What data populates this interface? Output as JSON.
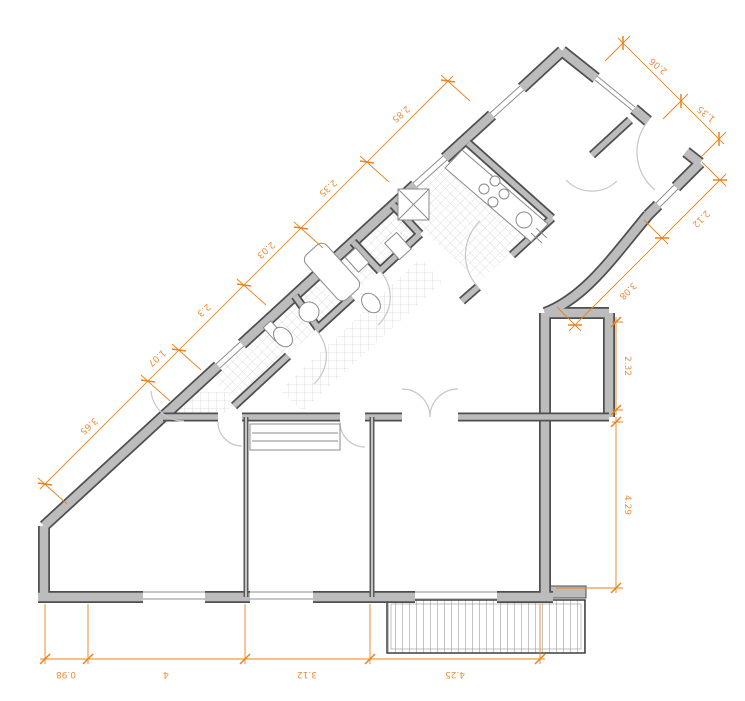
{
  "drawing": {
    "kind": "apartment floor plan",
    "units": "m"
  },
  "colors": {
    "dimension_line": "#E8831D",
    "dimension_text": "#EA8F3C",
    "wall_fill": "#bcbcbc",
    "wall_outline": "#4f4f4f",
    "background": "#ffffff"
  },
  "dimensions": {
    "diagonal_chain": {
      "labels": [
        "3.65",
        "1.07",
        "2.3",
        "2.03",
        "2.35",
        "2.85"
      ]
    },
    "top_right_chain": {
      "labels": [
        "2.06",
        "1.35"
      ]
    },
    "right_diagonal_chain": {
      "labels": [
        "2.12",
        "3.08"
      ]
    },
    "right_vertical_chain": {
      "labels": [
        "2.32",
        "4.29"
      ]
    },
    "bottom_chain": {
      "labels": [
        "0.98",
        "4",
        "3.12",
        "4.25"
      ]
    }
  }
}
